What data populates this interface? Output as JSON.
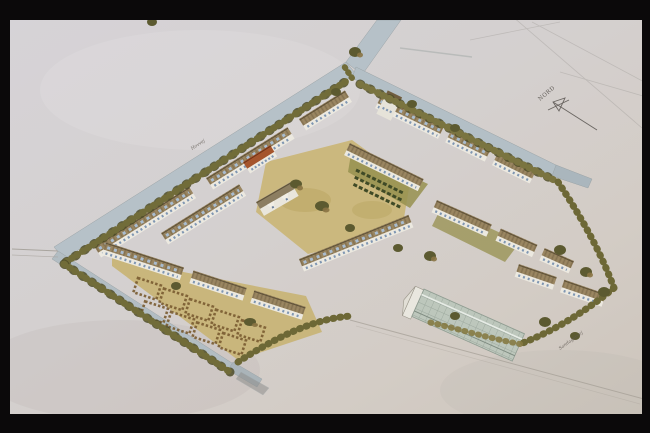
{
  "scene": {
    "kind": "slide photograph of an architectural watercolour",
    "subject": "aerial axonometric perspective of a courtyard housing estate with perimeter streets, tree rows, allotment gardens, inner green courts and a long greenhouse wing"
  },
  "labels": {
    "north_arrow": "NORD",
    "street_nw": "Hovvej",
    "street_se": "Sandagervej"
  },
  "palette": {
    "frame": "#0b090a",
    "paper": "#d4d0d2",
    "paper_warm": "#d2cac2",
    "road": "#b5c0c7",
    "roof": "#92805c",
    "roof_dark": "#6f5d40",
    "roof_red": "#a5552d",
    "wall": "#ece9e0",
    "window_blue": "#8ba2bf",
    "dormer_blue": "#a9bccf",
    "hedge": "#716c39",
    "hedge_dark": "#4f4c28",
    "courtyard_tan": "#cbb87e",
    "allotment_hedge": "#7a5c31",
    "glass": "#bdc7bc",
    "pencil": "#6a6561"
  }
}
